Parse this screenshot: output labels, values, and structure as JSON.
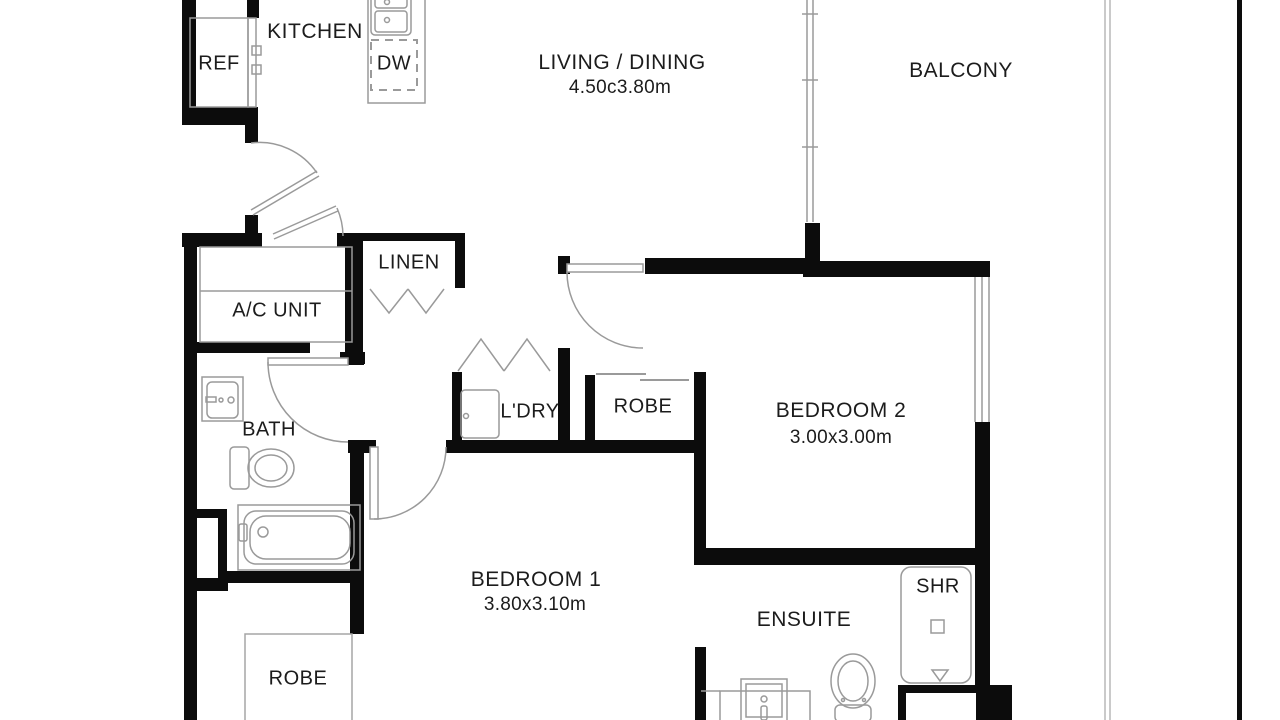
{
  "plan": {
    "type": "apartment-floor-plan",
    "rooms": {
      "kitchen": {
        "label": "KITCHEN"
      },
      "fridge": {
        "label": "REF"
      },
      "dishwasher": {
        "label": "DW"
      },
      "living": {
        "label": "LIVING / DINING",
        "dims": "4.50c3.80m"
      },
      "balcony": {
        "label": "BALCONY"
      },
      "linen": {
        "label": "LINEN"
      },
      "ac_unit": {
        "label": "A/C UNIT"
      },
      "bath": {
        "label": "BATH"
      },
      "laundry": {
        "label": "L'DRY"
      },
      "robe_hall": {
        "label": "ROBE"
      },
      "bedroom2": {
        "label": "BEDROOM 2",
        "dims": "3.00x3.00m"
      },
      "bedroom1": {
        "label": "BEDROOM 1",
        "dims": "3.80x3.10m"
      },
      "ensuite": {
        "label": "ENSUITE"
      },
      "shower": {
        "label": "SHR"
      },
      "robe_bed1": {
        "label": "ROBE"
      }
    },
    "colors": {
      "wall": "#0c0c0c",
      "fixture": "#9a9a9a",
      "text": "#1c1c1c",
      "boundary": "#b8b8b8",
      "background": "#ffffff"
    }
  }
}
